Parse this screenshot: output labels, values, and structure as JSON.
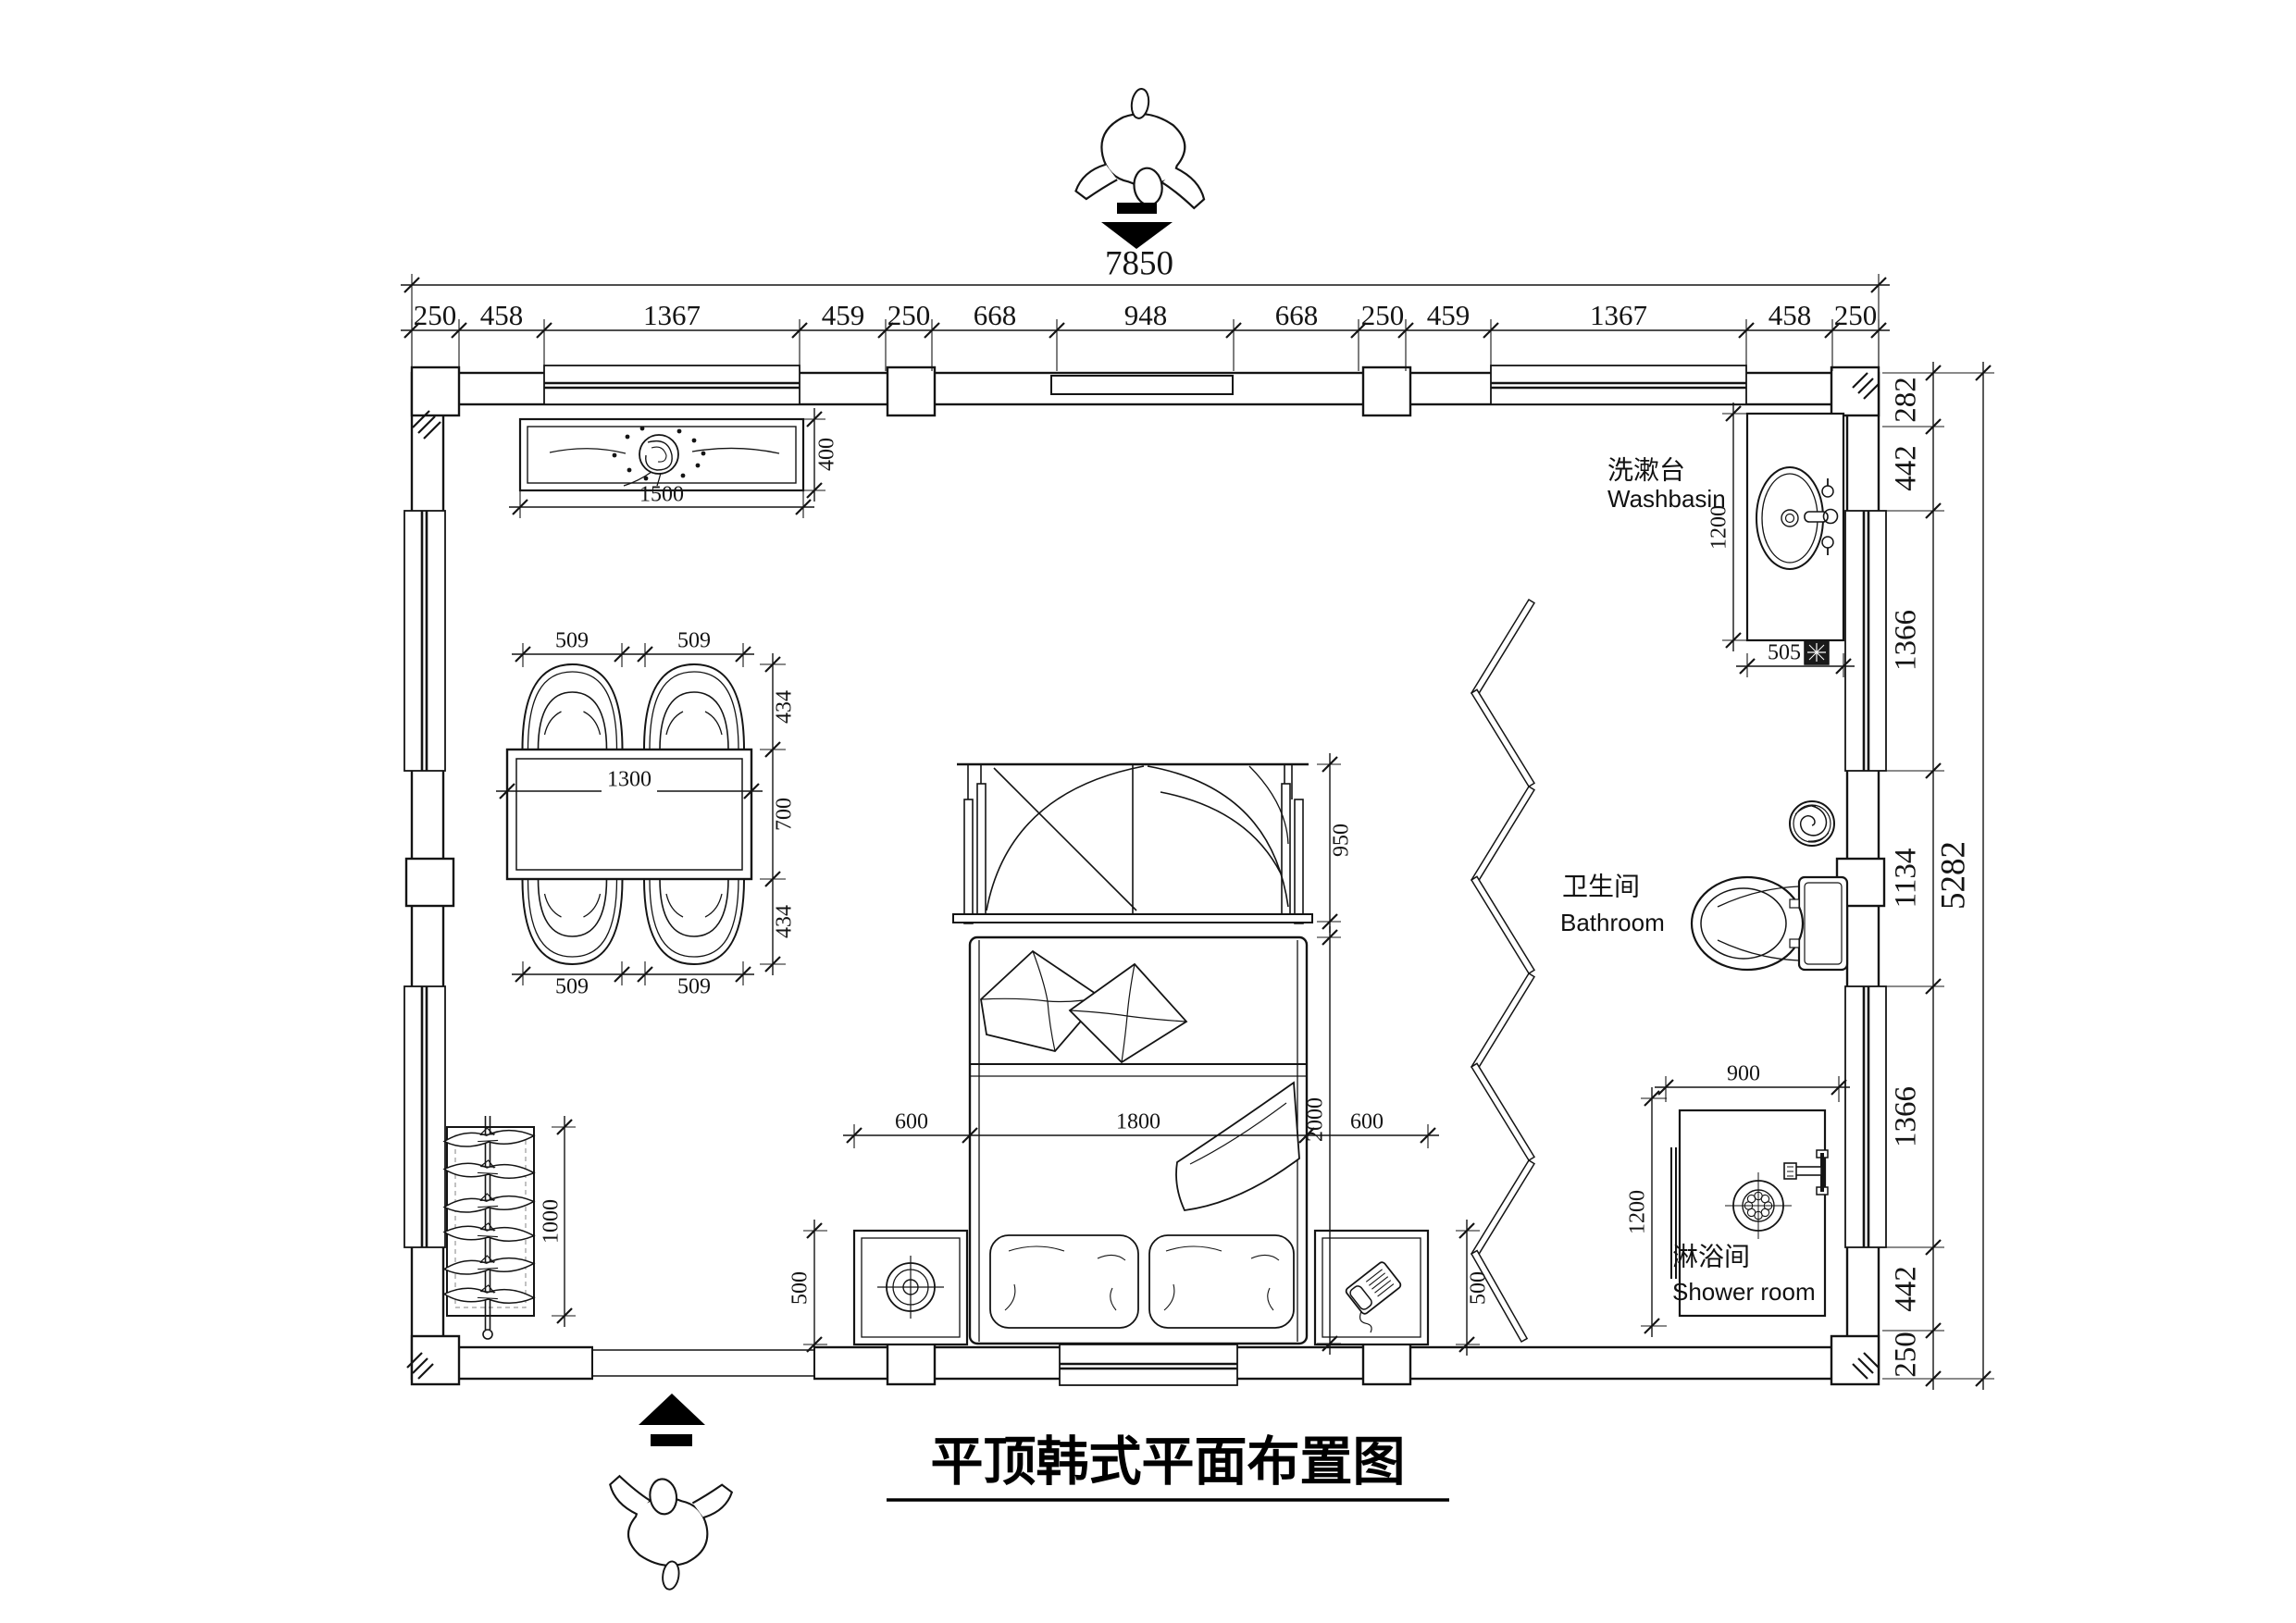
{
  "title": "平顶韩式平面布置图",
  "dims_top": {
    "total": "7850",
    "chain": [
      "250",
      "458",
      "1367",
      "459",
      "250",
      "668",
      "948",
      "668",
      "250",
      "459",
      "1367",
      "458",
      "250"
    ]
  },
  "dims_right": {
    "total": "5282",
    "chain": [
      "282",
      "442",
      "1366",
      "1134",
      "1366",
      "442",
      "250"
    ]
  },
  "cabinet": {
    "width": "1500",
    "depth": "400"
  },
  "dining_table": {
    "length": "1300",
    "depth": "700",
    "chair_width": "509",
    "chair_depth": "434"
  },
  "wardrobe": {
    "length": "1000"
  },
  "bed": {
    "width": "1800",
    "length": "2000",
    "canopy_depth": "950",
    "side_clearance": "600",
    "nightstand_depth": "500"
  },
  "washbasin": {
    "label_zh": "洗漱台",
    "label_en": "Washbasin",
    "counter_length": "1200",
    "counter_width": "505"
  },
  "bathroom": {
    "label_zh": "卫生间",
    "label_en": "Bathroom"
  },
  "shower": {
    "label_zh": "淋浴间",
    "label_en": "Shower room",
    "width": "900",
    "depth": "1200"
  }
}
